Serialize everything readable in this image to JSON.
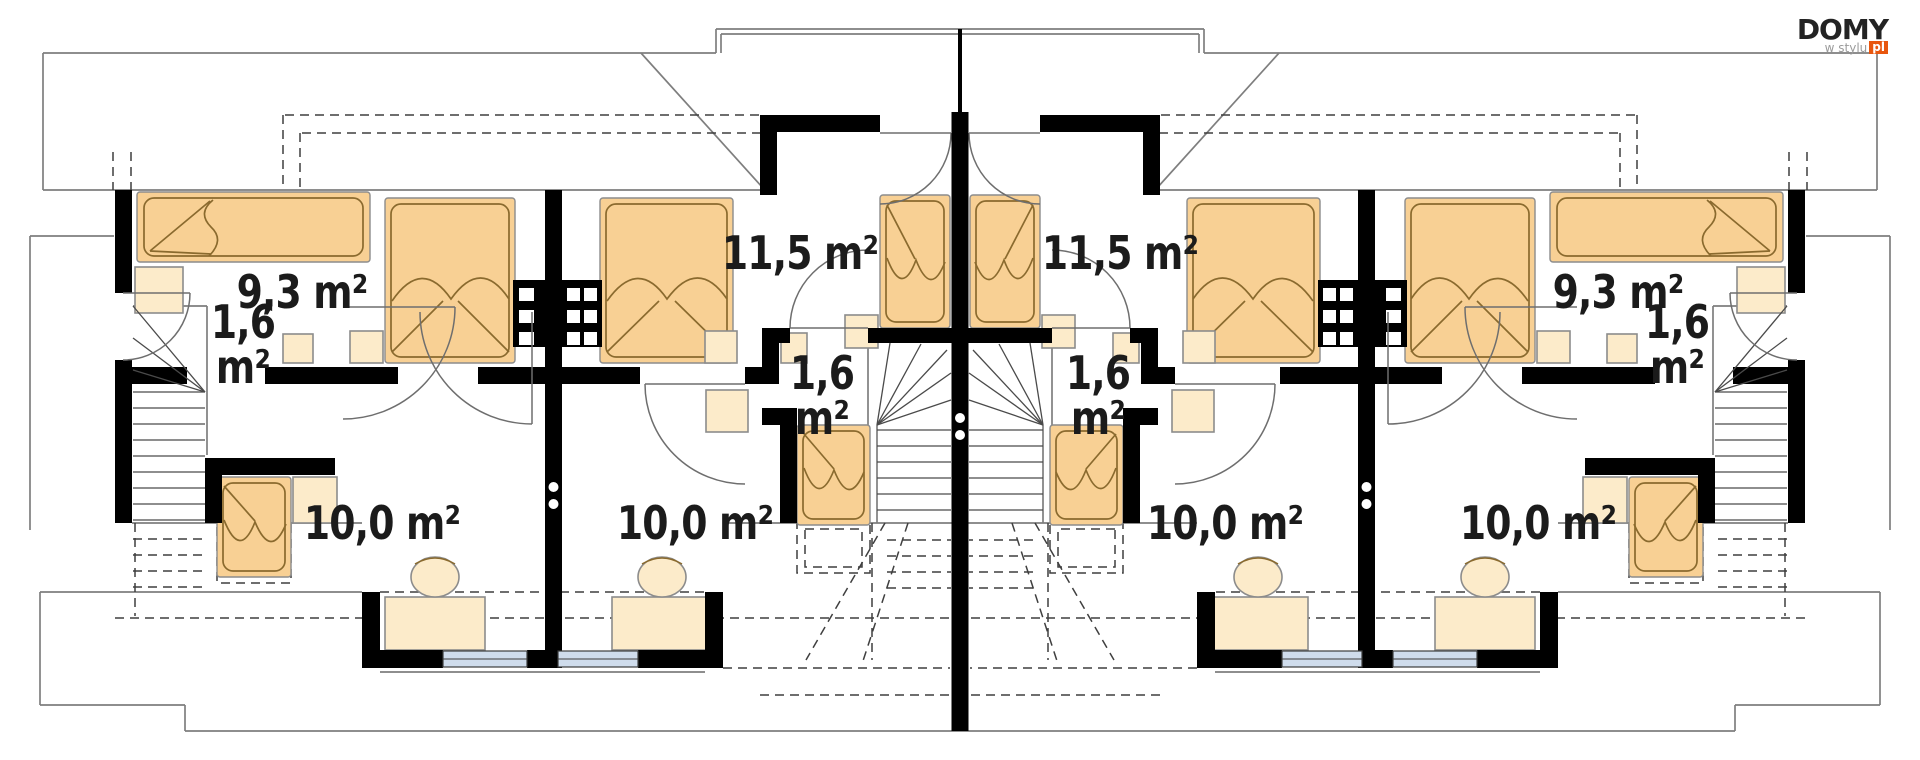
{
  "logo": {
    "brand": "DOMY",
    "tagline": "w stylu",
    "suffix": "pl"
  },
  "colors": {
    "background": "#ffffff",
    "wall": "#000000",
    "line": "#7e7e7e",
    "dash": "#3f3f3f",
    "stair": "#4a4a4a",
    "door": "#6e6e6e",
    "furniture": "#f8d094",
    "furniture_light": "#fcebca",
    "furniture_stroke": "#8a6a2e",
    "furniture_edge": "#8c8c8c",
    "window": "#cfdcec",
    "window_frame": "#3c3c3c",
    "text": "#1b1b1b",
    "logo_dark": "#232323",
    "logo_gray": "#9b9b9b",
    "logo_orange": "#e8560e"
  },
  "labels": {
    "bedrooms": [
      {
        "id": "bedroom-left-outer",
        "text": "9,3 m²"
      },
      {
        "id": "bedroom-left-inner",
        "text": "11,5 m²"
      },
      {
        "id": "bedroom-right-inner",
        "text": "11,5 m²"
      },
      {
        "id": "bedroom-right-outer",
        "text": "9,3 m²"
      }
    ],
    "halls": [
      {
        "id": "hall-left-outer",
        "line1": "1,6",
        "line2": "m²"
      },
      {
        "id": "hall-left-inner",
        "line1": "1,6",
        "line2": "m²"
      },
      {
        "id": "hall-right-inner",
        "line1": "1,6",
        "line2": "m²"
      },
      {
        "id": "hall-right-outer",
        "line1": "1,6",
        "line2": "m²"
      }
    ],
    "rooms": [
      {
        "id": "room-left-outer",
        "text": "10,0 m²"
      },
      {
        "id": "room-left-inner",
        "text": "10,0 m²"
      },
      {
        "id": "room-right-inner",
        "text": "10,0 m²"
      },
      {
        "id": "room-right-outer",
        "text": "10,0 m²"
      }
    ]
  }
}
